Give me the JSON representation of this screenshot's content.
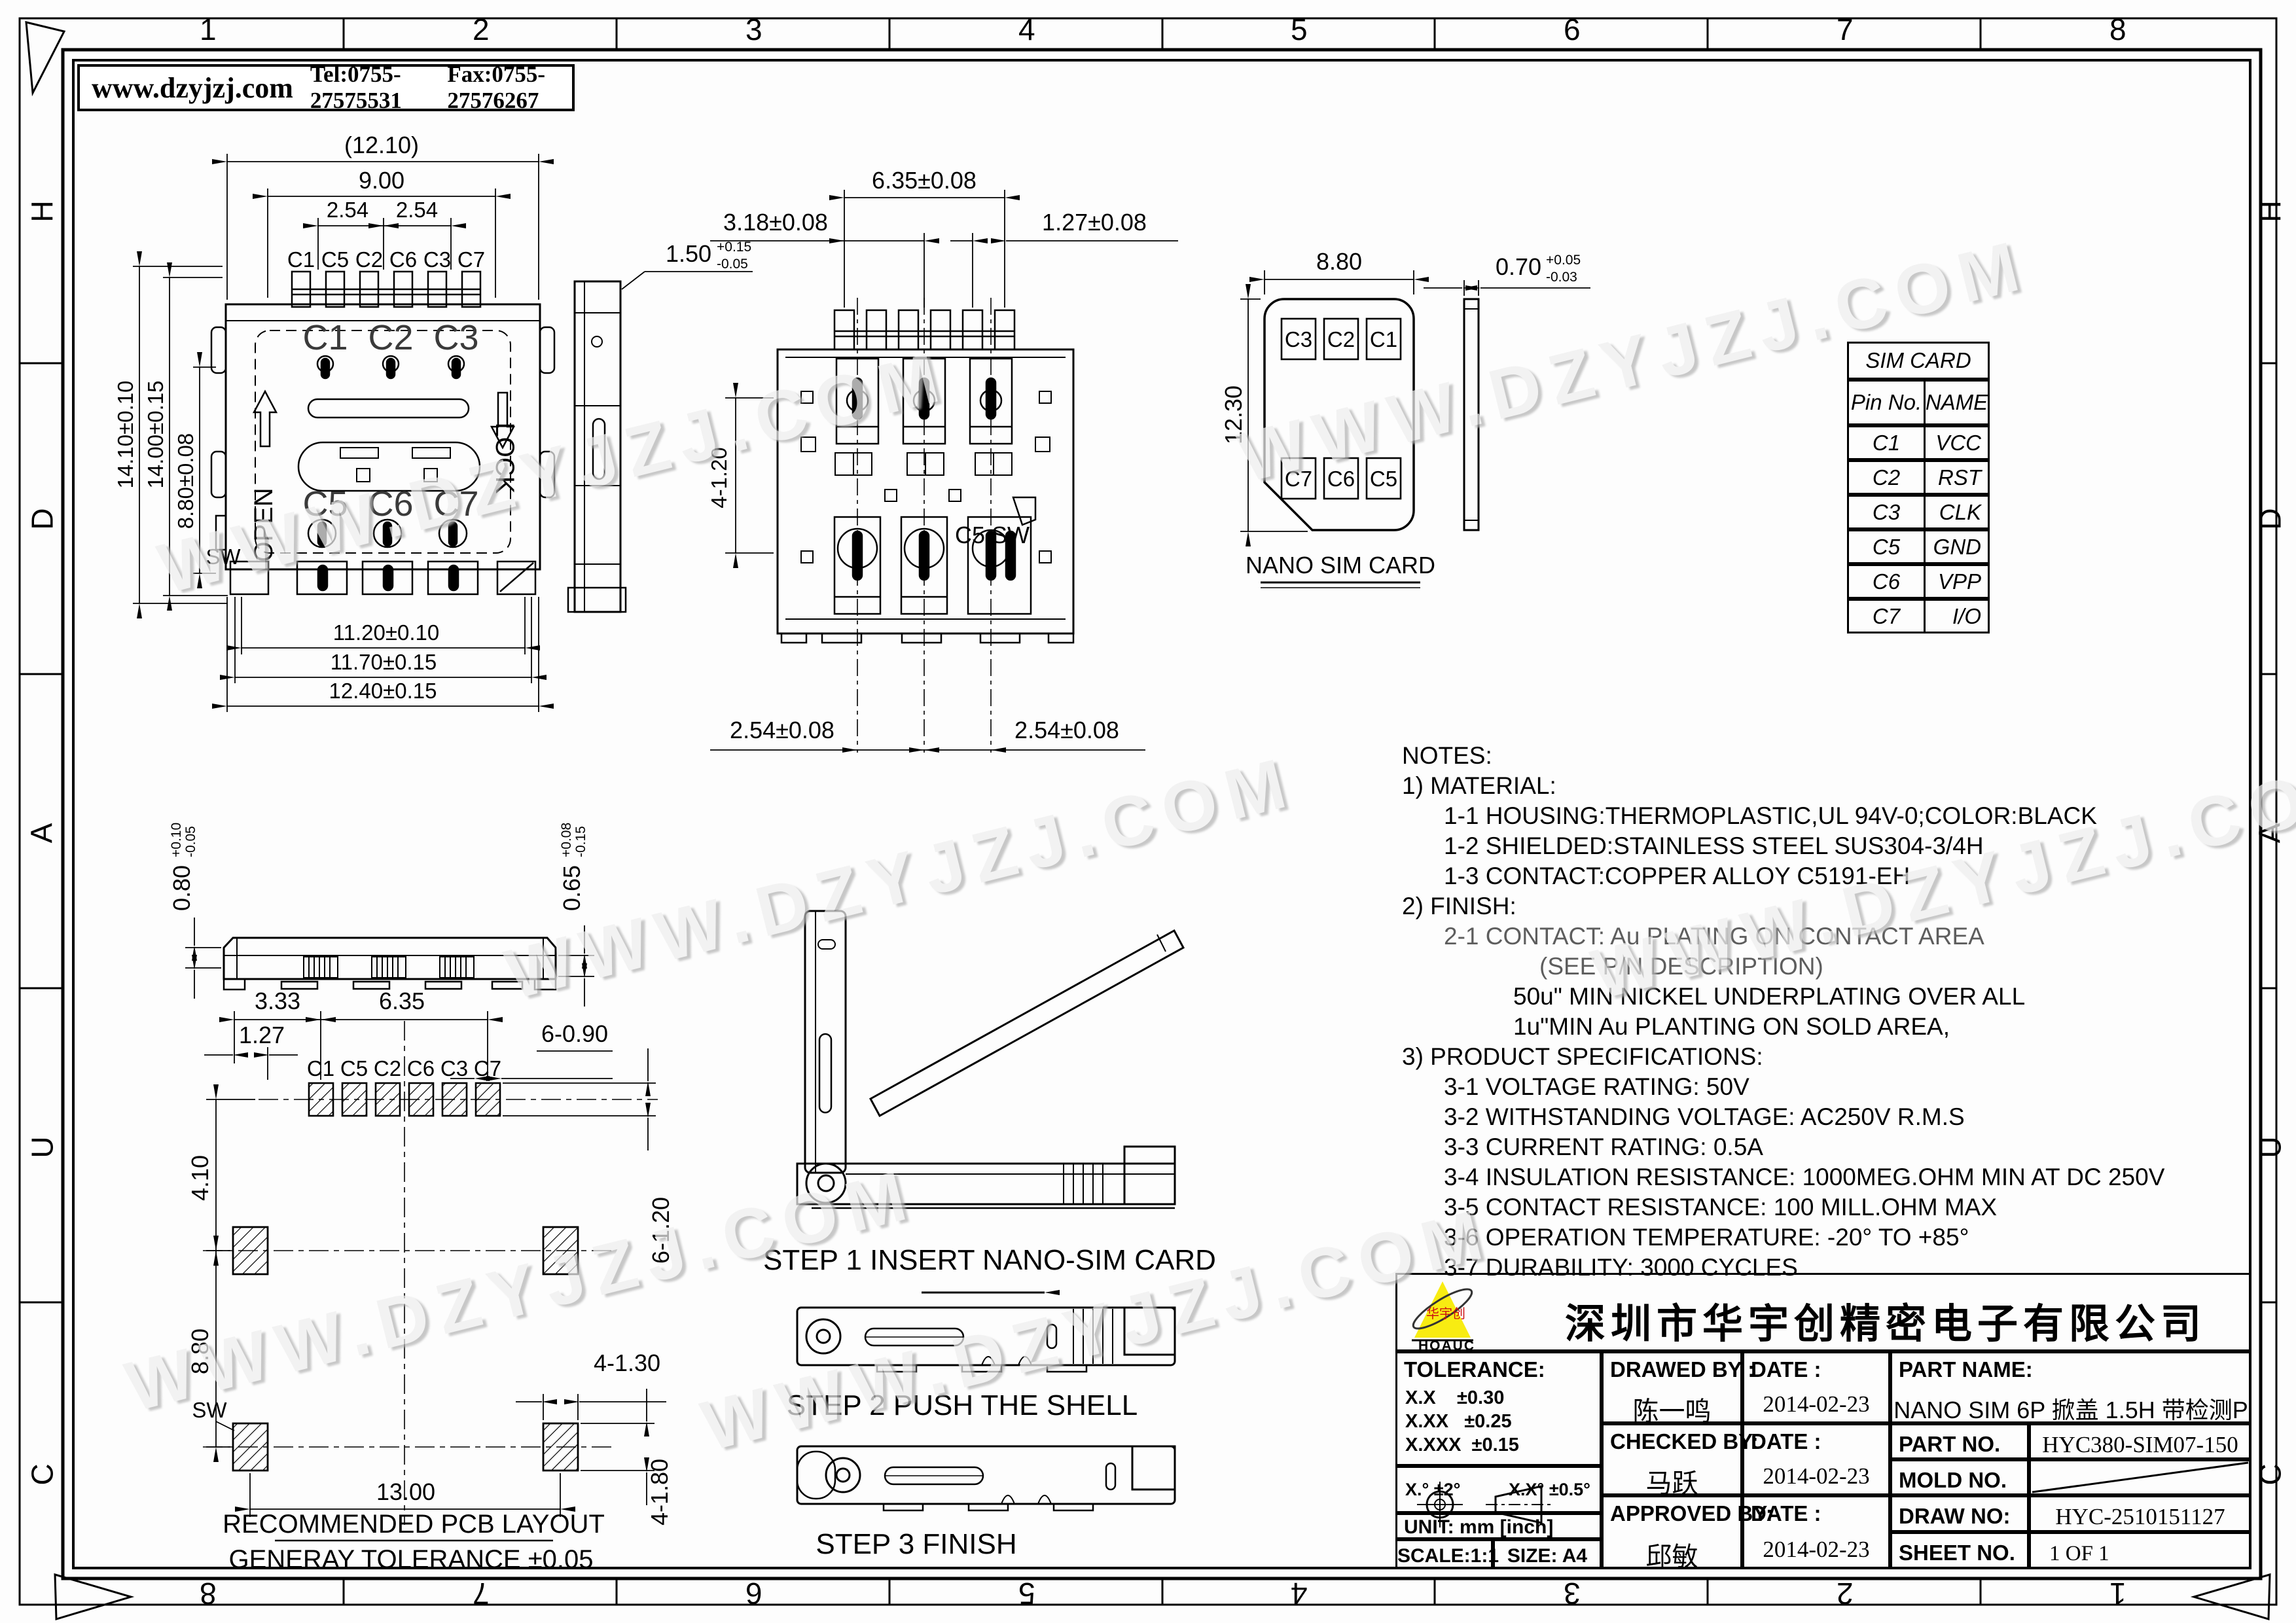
{
  "header": {
    "website": "www.dzyjzj.com",
    "tel": "Tel:0755-27575531",
    "fax": "Fax:0755-27576267"
  },
  "watermark": {
    "text": "WWW.DZYJZJ.COM"
  },
  "border": {
    "top": [
      "1",
      "2",
      "3",
      "4",
      "5",
      "6",
      "7",
      "8"
    ],
    "bottom": [
      "8",
      "7",
      "6",
      "5",
      "4",
      "3",
      "2",
      "1"
    ],
    "left": [
      "H",
      "D",
      "A",
      "U",
      "C"
    ],
    "right": [
      "H",
      "D",
      "A",
      "U",
      "C"
    ]
  },
  "front_view": {
    "contacts": [
      "C1",
      "C5",
      "C2",
      "C6",
      "C3",
      "C7"
    ],
    "inner_top": [
      "C1",
      "C2",
      "C3"
    ],
    "inner_bottom": [
      "C5",
      "C6",
      "C7"
    ],
    "open": "OPEN",
    "lock": "LOCK",
    "sw": "SW",
    "dims": {
      "overall_w": "(12.10)",
      "pins_w": "9.00",
      "pitch_a": "2.54",
      "pitch_b": "2.54",
      "h1": "14.10±0.10",
      "h2": "14.00±0.15",
      "h3": "8.80±0.08",
      "b1": "11.20±0.10",
      "b2": "11.70±0.15",
      "b3": "12.40±0.15"
    }
  },
  "side_view": {
    "dim": {
      "v": "1.50",
      "up": "+0.15",
      "dn": "-0.05"
    }
  },
  "top_view": {
    "dims": {
      "w": "6.35±0.08",
      "l": "3.18±0.08",
      "r": "1.27±0.08",
      "slot": "4-1.20",
      "p1": "2.54±0.08",
      "p2": "2.54±0.08"
    },
    "sw_label": "C5 SW"
  },
  "sim_card": {
    "w": "8.80",
    "h": "12.30",
    "pads_top": [
      "C3",
      "C2",
      "C1"
    ],
    "pads_bottom": [
      "C7",
      "C6",
      "C5"
    ],
    "caption": "NANO SIM CARD",
    "thickness": {
      "v": "0.70",
      "up": "+0.05",
      "dn": "-0.03"
    }
  },
  "bottom_view": {
    "left": {
      "v": "0.80",
      "up": "+0.10",
      "dn": "-0.05"
    },
    "right": {
      "v": "0.65",
      "up": "+0.08",
      "dn": "-0.15"
    }
  },
  "pcb": {
    "labels": [
      "C1",
      "C5",
      "C2",
      "C6",
      "C3",
      "C7"
    ],
    "dims": {
      "d1": "3.33",
      "d2": "6.35",
      "d3": "1.27",
      "d4": "6-0.90",
      "d5": "4.10",
      "d6": "8.80",
      "d7": "13.00",
      "d8": "4-1.30",
      "d9": "4-1.80",
      "d10": "6-1.20"
    },
    "sw": "SW",
    "caption": "RECOMMENDED PCB LAYOUT",
    "tolerance": "GENERAY TOLERANCE ±0.05"
  },
  "steps": {
    "s1": "STEP 1 INSERT NANO-SIM CARD",
    "s2": "STEP 2   PUSH THE SHELL",
    "s3": "STEP 3   FINISH"
  },
  "notes": {
    "lines": [
      "NOTES:",
      "1) MATERIAL:",
      "1-1 HOUSING:THERMOPLASTIC,UL 94V-0;COLOR:BLACK",
      "1-2 SHIELDED:STAINLESS STEEL SUS304-3/4H",
      "1-3 CONTACT:COPPER ALLOY C5191-EH",
      "2) FINISH:",
      "2-1 CONTACT:  Au PLATING ON CONTACT AREA",
      "(SEE P/N DESCRIPTION)",
      "50u\" MIN NICKEL UNDERPLATING OVER ALL",
      "1u\"MIN Au PLANTING ON SOLD AREA,",
      "3) PRODUCT SPECIFICATIONS:",
      "3-1 VOLTAGE RATING: 50V",
      "3-2 WITHSTANDING VOLTAGE: AC250V R.M.S",
      "3-3 CURRENT RATING: 0.5A",
      "3-4 INSULATION RESISTANCE: 1000MEG.OHM MIN AT DC 250V",
      "3-5 CONTACT RESISTANCE: 100 MILL.OHM MAX",
      "3-6 OPERATION TEMPERATURE: -20° TO +85°",
      "3-7 DURABILITY: 3000 CYCLES"
    ]
  },
  "pin_table": {
    "title": "SIM CARD",
    "col_pin": "Pin No.",
    "col_name": "NAME",
    "rows": [
      {
        "pin": "C1",
        "name": "VCC"
      },
      {
        "pin": "C2",
        "name": "RST"
      },
      {
        "pin": "C3",
        "name": "CLK"
      },
      {
        "pin": "C5",
        "name": "GND"
      },
      {
        "pin": "C6",
        "name": "VPP"
      },
      {
        "pin": "C7",
        "name": "I/O"
      }
    ]
  },
  "title_block": {
    "company": "深圳市华宇创精密电子有限公司",
    "logo": {
      "text": "华宇创",
      "sub": "HOAUC"
    },
    "tolerance": {
      "label": "TOLERANCE:",
      "r1": "X.X    ±0.30",
      "r2": "X.XX   ±0.25",
      "r3": "X.XXX  ±0.15",
      "a1": "X.°  ±2°",
      "a2": "X.X°  ±0.5°"
    },
    "unit": "UNIT:  mm  [inch]",
    "scale": "SCALE:1:1",
    "size": "SIZE:  A4",
    "drawed": {
      "label": "DRAWED BY :",
      "date_label": "DATE :",
      "name": "陈一鸣",
      "date": "2014-02-23"
    },
    "checked": {
      "label": "CHECKED BY:",
      "date_label": "DATE :",
      "name": "马跃",
      "date": "2014-02-23"
    },
    "approved": {
      "label": "APPROVED BY:",
      "date_label": "DATE :",
      "name": "邱敏",
      "date": "2014-02-23"
    },
    "part_name": {
      "label": "PART NAME:",
      "value": "NANO SIM 6P 掀盖 1.5H 带检测P"
    },
    "part_no": {
      "label": "PART NO.",
      "value": "HYC380-SIM07-150"
    },
    "mold_no": {
      "label": "MOLD NO.",
      "value": ""
    },
    "draw_no": {
      "label": "DRAW NO:",
      "value": "HYC-2510151127"
    },
    "sheet": {
      "label": "SHEET NO.",
      "value": "1 OF 1"
    }
  }
}
